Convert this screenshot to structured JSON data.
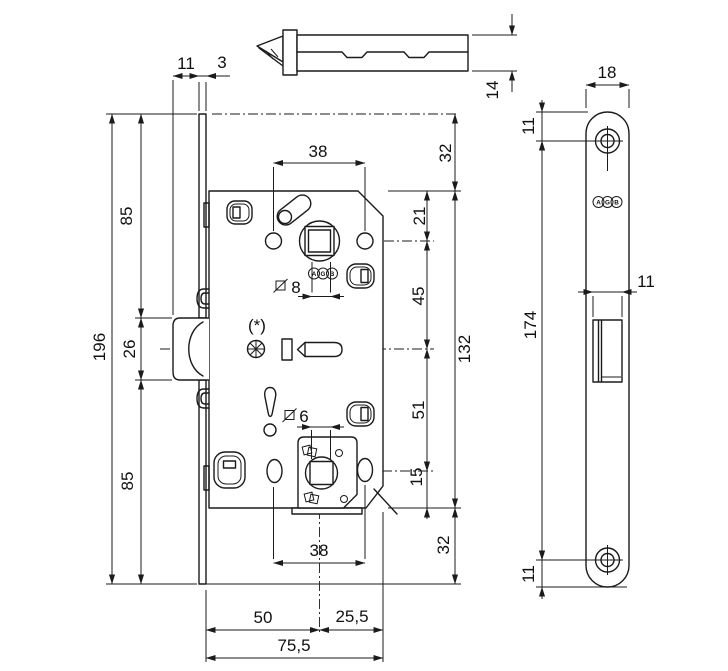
{
  "drawing": {
    "brand_letters": [
      "A",
      "G",
      "B"
    ],
    "note_star": "(*)",
    "latch_part": {
      "height": "14"
    },
    "side_view": {
      "latch_protrusion": "11",
      "faceplate_thickness": "3",
      "top_to_latch": "85",
      "faceplate_height": "196",
      "latch_height": "26",
      "latch_to_bottom": "85",
      "fixing_hole_span_top": "38",
      "square_spindle_handle": "8",
      "square_spindle_wc": "6",
      "fixing_hole_span_bottom": "38",
      "backset": "50",
      "spindle_to_back": "25,5",
      "total_depth": "75,5",
      "plate_top_to_body": "32",
      "body_top_to_spindle": "21",
      "spindle_to_latch_axis": "45",
      "body_height": "132",
      "latch_axis_to_wc": "51",
      "wc_to_body_bottom": "15",
      "body_bottom_to_plate": "32"
    },
    "front_view": {
      "plate_width": "18",
      "top_to_hole": "11",
      "hole_span": "174",
      "hole_to_bottom": "11",
      "latch_width": "11"
    }
  }
}
